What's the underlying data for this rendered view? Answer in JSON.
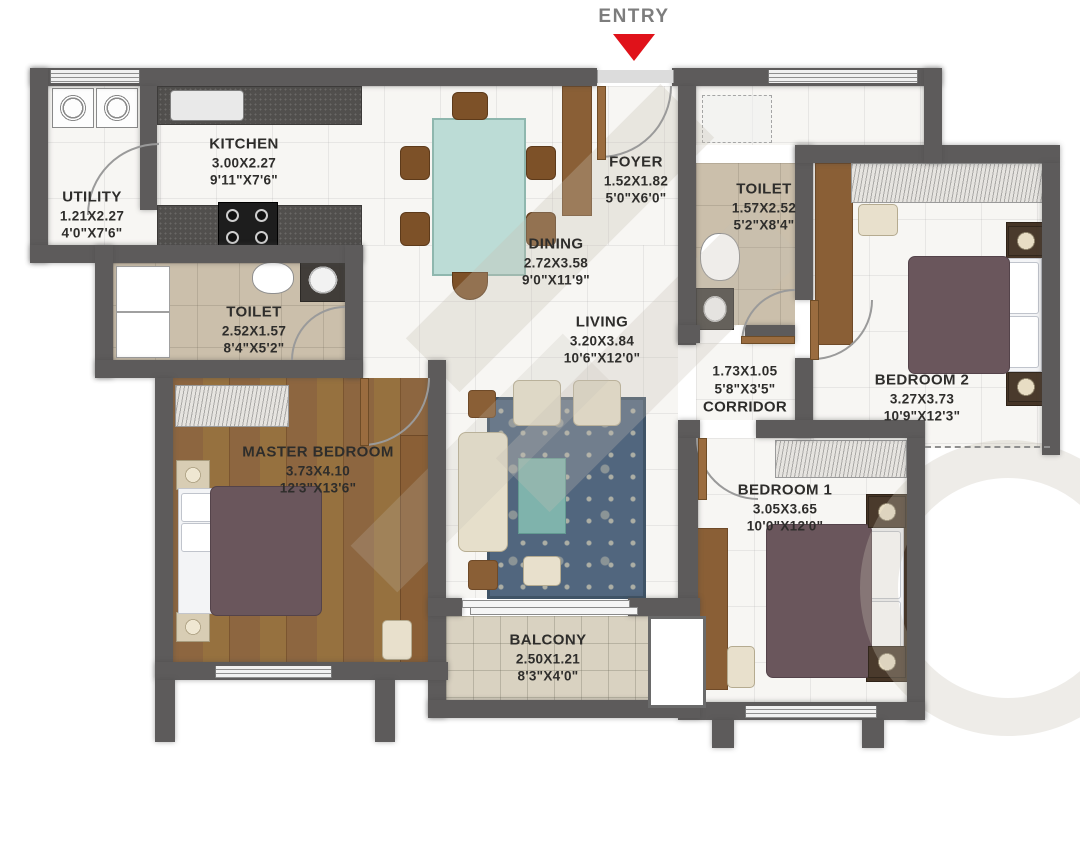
{
  "entry": {
    "label": "ENTRY"
  },
  "rooms": {
    "kitchen": {
      "lines": [
        "KITCHEN",
        "3.00X2.27",
        "9'11\"X7'6\""
      ]
    },
    "utility": {
      "lines": [
        "UTILITY",
        "1.21X2.27",
        "4'0\"X7'6\""
      ]
    },
    "foyer": {
      "lines": [
        "FOYER",
        "1.52X1.82",
        "5'0\"X6'0\""
      ]
    },
    "toilet_top": {
      "lines": [
        "TOILET",
        "1.57X2.52",
        "5'2\"X8'4\""
      ]
    },
    "dining": {
      "lines": [
        "DINING",
        "2.72X3.58",
        "9'0\"X11'9\""
      ]
    },
    "toilet_left": {
      "lines": [
        "TOILET",
        "2.52X1.57",
        "8'4\"X5'2\""
      ]
    },
    "living": {
      "lines": [
        "LIVING",
        "3.20X3.84",
        "10'6\"X12'0\""
      ]
    },
    "corridor": {
      "lines": [
        "1.73X1.05",
        "5'8\"X3'5\"",
        "CORRIDOR"
      ]
    },
    "bedroom2": {
      "lines": [
        "BEDROOM 2",
        "3.27X3.73",
        "10'9\"X12'3\""
      ]
    },
    "master": {
      "lines": [
        "MASTER BEDROOM",
        "3.73X4.10",
        "12'3\"X13'6\""
      ]
    },
    "bedroom1": {
      "lines": [
        "BEDROOM 1",
        "3.05X3.65",
        "10'0\"X12'0\""
      ]
    },
    "balcony": {
      "lines": [
        "BALCONY",
        "2.50X1.21",
        "8'3\"X4'0\""
      ]
    }
  },
  "colors": {
    "wall": "#5d5b5b",
    "entry_arrow": "#e0121a",
    "marble_floor": "#f7f6f3",
    "toilet_floor": "#cbbfab",
    "wood_floor": "#8d6640",
    "balcony_floor": "#d9d2c1",
    "rug": "#51667e",
    "rug_center": "#7fb3ac",
    "dining_table": "#bcdcd6",
    "duvet": "#6a565c"
  },
  "icons": {
    "entry_arrow": "triangle-down"
  }
}
